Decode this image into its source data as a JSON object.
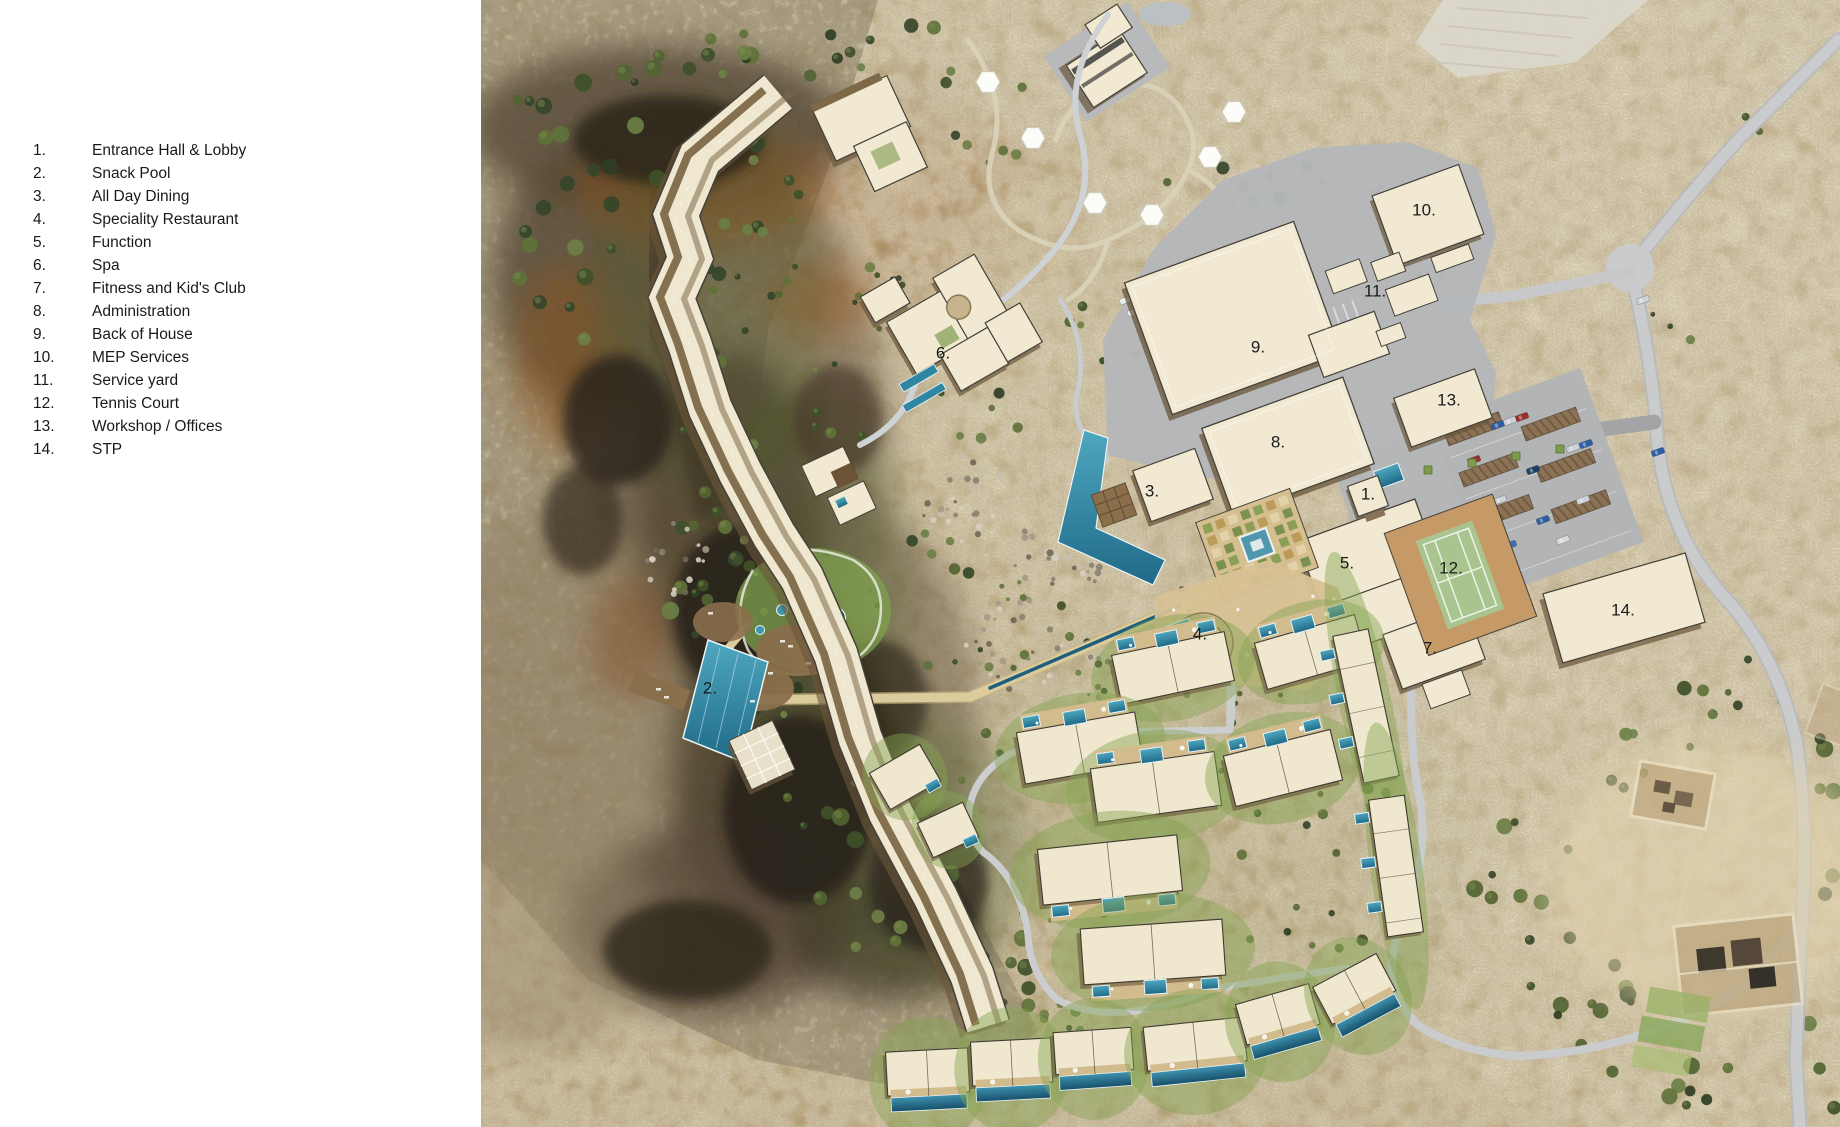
{
  "legend": {
    "items": [
      {
        "num": "1.",
        "label": "Entrance Hall & Lobby"
      },
      {
        "num": "2.",
        "label": "Snack Pool"
      },
      {
        "num": "3.",
        "label": "All Day Dining"
      },
      {
        "num": "4.",
        "label": "Speciality Restaurant"
      },
      {
        "num": "5.",
        "label": "Function"
      },
      {
        "num": "6.",
        "label": "Spa"
      },
      {
        "num": "7.",
        "label": "Fitness and Kid's Club"
      },
      {
        "num": "8.",
        "label": "Administration"
      },
      {
        "num": "9.",
        "label": "Back of House"
      },
      {
        "num": "10.",
        "label": "MEP Services"
      },
      {
        "num": "11.",
        "label": "Service yard"
      },
      {
        "num": "12.",
        "label": "Tennis Court"
      },
      {
        "num": "13.",
        "label": "Workshop / Offices"
      },
      {
        "num": "14.",
        "label": "STP"
      }
    ]
  },
  "map": {
    "labels": [
      {
        "num": "1.",
        "x": 960,
        "y": 494
      },
      {
        "num": "2.",
        "x": 302,
        "y": 688
      },
      {
        "num": "3.",
        "x": 744,
        "y": 491
      },
      {
        "num": "4.",
        "x": 792,
        "y": 634
      },
      {
        "num": "5.",
        "x": 939,
        "y": 563
      },
      {
        "num": "6.",
        "x": 535,
        "y": 353
      },
      {
        "num": "7.",
        "x": 1022,
        "y": 648
      },
      {
        "num": "8.",
        "x": 870,
        "y": 442
      },
      {
        "num": "9.",
        "x": 850,
        "y": 347
      },
      {
        "num": "10.",
        "x": 1016,
        "y": 210
      },
      {
        "num": "11.",
        "x": 967,
        "y": 291
      },
      {
        "num": "12.",
        "x": 1043,
        "y": 568
      },
      {
        "num": "13.",
        "x": 1041,
        "y": 400
      },
      {
        "num": "14.",
        "x": 1215,
        "y": 610
      }
    ],
    "colors": {
      "sand": "#d5c296",
      "sand_light": "#e6d9b6",
      "sand_dark": "#c0ab80",
      "rock_dark": "#2c2619",
      "rock_brown": "#5a4d38",
      "burnt": "#96521f",
      "road": "#c6c8ca",
      "service_apron": "#b5b7b9",
      "path_tan": "#dbcb9d",
      "building": "#f1e9d1",
      "building_edge": "#45413a",
      "shadow_brown": "#6a563a",
      "balcony_brown": "#7d6848",
      "pool": "#2f86a3",
      "pool_dark": "#1d5f7d",
      "lawn": "#86a452",
      "tree": "#46572e",
      "tennis_court": "#a9c48e",
      "tennis_surround": "#c59a66",
      "canopy_brown": "#8b7256",
      "label_text": "#1b1b1b"
    }
  }
}
